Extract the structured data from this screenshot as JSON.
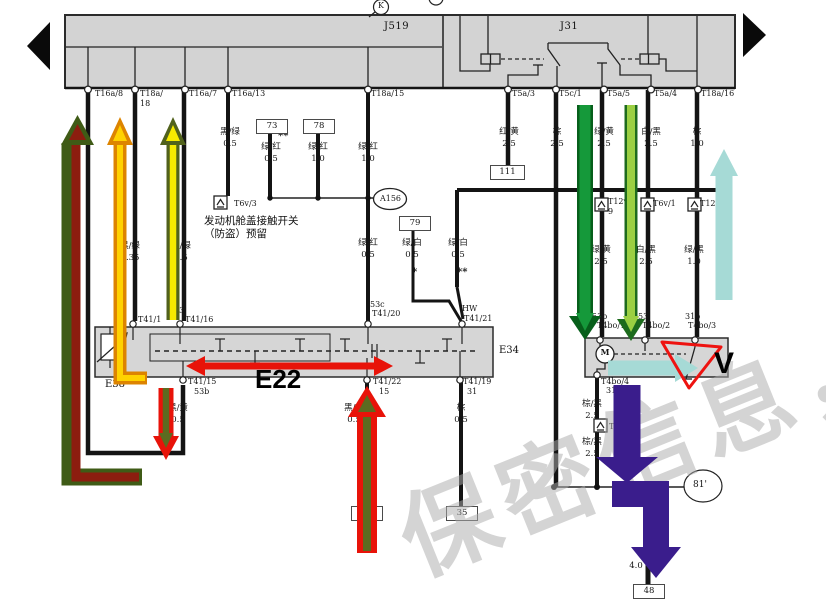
{
  "header": {
    "k": "K",
    "j519": "J519",
    "j31": "J31"
  },
  "terminals": {
    "t16a8": "T16a/8",
    "t18a18": "T18a/\n18",
    "t16a7": "T16a/7",
    "t16a13": "T16a/13",
    "t18a15": "T18a/15",
    "t5a3": "T5a/3",
    "t5c1": "T5c/1",
    "t5a5": "T5a/5",
    "t5a4": "T5a/4",
    "t18a16": "T18a/16"
  },
  "wire_labels": {
    "wl1": "黑/绿\n0.5",
    "wl2": "绿/红\n0.5",
    "wl3": "绿/红\n1.0",
    "wl4": "绿/红\n1.0",
    "wl5": "红/黄\n2.5",
    "wl6": "棕\n2.5",
    "wl7": "绿/黄\n2.5",
    "wl8": "白/黑\n2.5",
    "wl9": "棕\n1.0",
    "wl10": "黑/绿\n0.35",
    "wl11": "黑/绿\n0.5",
    "wl12": "绿/红\n0.5",
    "wl13": "绿/白\n0.5",
    "wl14": "绿/白\n0.5",
    "wl15": "绿/黄\n2.5",
    "wl16": "白/黑\n2.5",
    "wl17": "绿/黑\n1.0",
    "wl18": "黑/黄\n0.5",
    "wl19": "黑/红\n0.5",
    "wl20": "棕\n0.5",
    "wl21": "棕/黑\n2.5",
    "wl22": "棕/黑\n2.5",
    "wl23": "4.0"
  },
  "stars": {
    "s1": "**",
    "s2": "*",
    "s3": "**"
  },
  "ref_boxes": {
    "b73": "73",
    "b78": "78",
    "b79": "79",
    "b111": "111",
    "b35": "35",
    "b48": "48",
    "b_hidden": ""
  },
  "components": {
    "t6v3": "T6v/3",
    "hood_switch_line1": "发动机舱盖接触开关",
    "hood_switch_line2": "（防盗）预留",
    "a156": "A156",
    "conn1": "T12v/\n9",
    "conn2": "T6v/1",
    "conn3": "T12v/8",
    "conn4": "T2a/2",
    "e38": "E38",
    "e34": "E34",
    "motor": "M",
    "ground81": "81'"
  },
  "e34_pins": {
    "t41_1": "T41/1",
    "p53": "53",
    "t41_16": "T41/16",
    "p53c": "53c",
    "t41_20": "T41/20",
    "hw": "HW",
    "t41_21": "T41/21",
    "t41_15": "T41/15",
    "p53b": "53b",
    "t41_22": "T41/22",
    "p15": "15",
    "t41_19": "T41/19",
    "p31": "31"
  },
  "motor_pins": {
    "p53b": "53b",
    "t4bo1": "T4bo/1",
    "p53": "53",
    "t4bo2": "T4bo/2",
    "p31b": "31b",
    "t4bo3": "T4bo/3",
    "t4bo4": "T4bo/4",
    "p31": "31"
  },
  "annotations": {
    "e22": "E22",
    "v": "V"
  },
  "watermark": {
    "text": "保密信息，"
  },
  "colors": {
    "highlight_red": "#e81309",
    "highlight_maroon": "#8c1d0f",
    "highlight_olive": "#5c6b20",
    "highlight_orange": "#dd8400",
    "highlight_yellow": "#f6ea00",
    "highlight_dark_green": "#0e8c2c",
    "highlight_light_green": "#9bcf42",
    "highlight_cyan": "#a6dad6",
    "highlight_purple": "#3a1d8c"
  }
}
